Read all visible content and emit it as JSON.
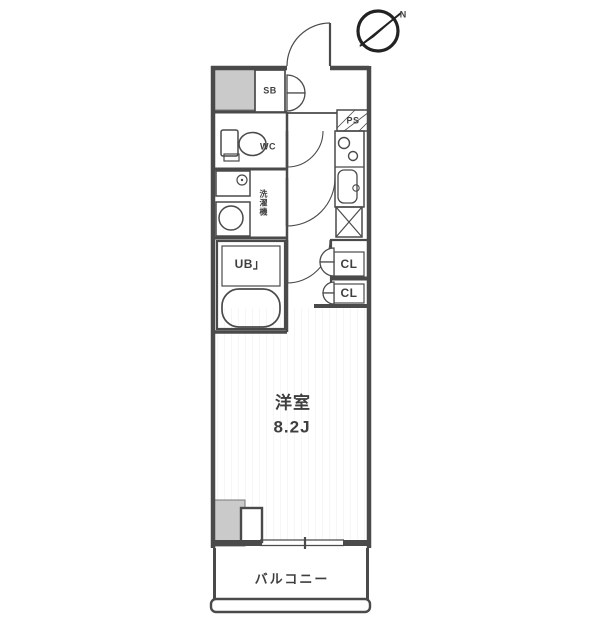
{
  "floor_plan": {
    "compass": {
      "north_label": "N"
    },
    "rooms": {
      "main_room": {
        "name": "洋室",
        "size": "8.2J"
      },
      "balcony": {
        "name": "バルコニー"
      },
      "unit_bath": {
        "label": "UB」"
      },
      "toilet": {
        "label": "WC"
      },
      "shoe_box": {
        "label": "SB"
      },
      "pipe_space": {
        "label": "PS"
      },
      "closet_upper": {
        "label": "CL"
      },
      "closet_lower": {
        "label": "CL"
      },
      "laundry": {
        "label": "洗濯機"
      }
    },
    "colors": {
      "line": "#4a4a4a",
      "wall_fill": "#cacaca",
      "background": "#ffffff",
      "text": "#3f3f3f"
    }
  }
}
